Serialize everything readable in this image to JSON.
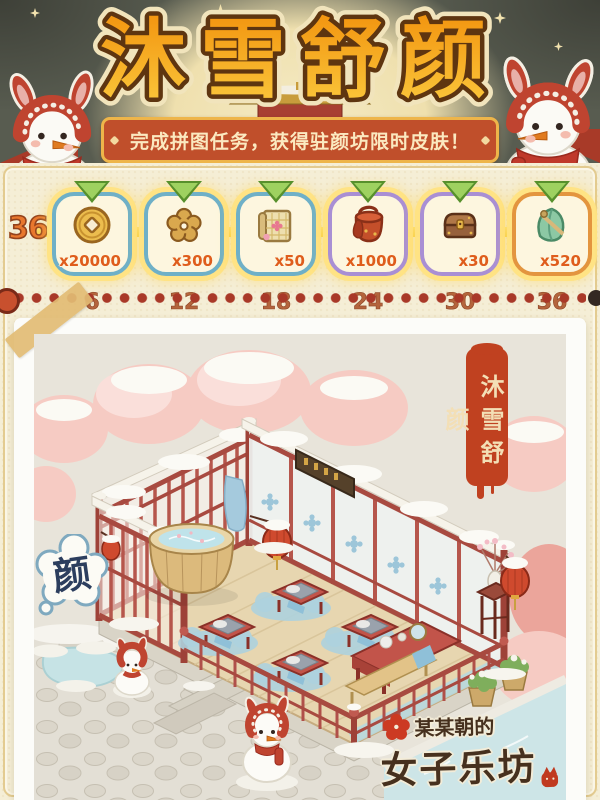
{
  "header": {
    "title": "沐雪舒颜",
    "banner_text": "完成拼图任务，获得驻颜坊限时皮肤！"
  },
  "progress": {
    "current_label": "36",
    "rewards": [
      {
        "item": "coin",
        "count": "x20000",
        "milestone": "6"
      },
      {
        "item": "plum-flower",
        "count": "x300",
        "milestone": "12"
      },
      {
        "item": "scroll",
        "count": "x50",
        "milestone": "18"
      },
      {
        "item": "red-tub",
        "count": "x1000",
        "milestone": "24"
      },
      {
        "item": "chest",
        "count": "x30",
        "milestone": "30"
      },
      {
        "item": "jade-pouch",
        "count": "x520",
        "milestone": "36"
      }
    ]
  },
  "illustration": {
    "stamp_text": "沐雪舒颜",
    "sign_text": "颜",
    "logo_top": "某某朝的",
    "logo_bottom": "女子乐坊"
  },
  "colors": {
    "title_gradient_top": "#f2930e",
    "title_gradient_bottom": "#fbc93d",
    "banner_bg": "#c04f2b",
    "banner_border": "#eeb54a",
    "card_border_blue": "#6fb0c7",
    "card_border_purple": "#a98fd4",
    "card_border_orange": "#e3953f",
    "count_text": "#df5d1c",
    "milestone_text": "#b4643c",
    "dot_color": "#a93928",
    "panel_bg": "#f5eed6",
    "stamp_bg": "#c04120",
    "header_bg": "#585c50"
  }
}
